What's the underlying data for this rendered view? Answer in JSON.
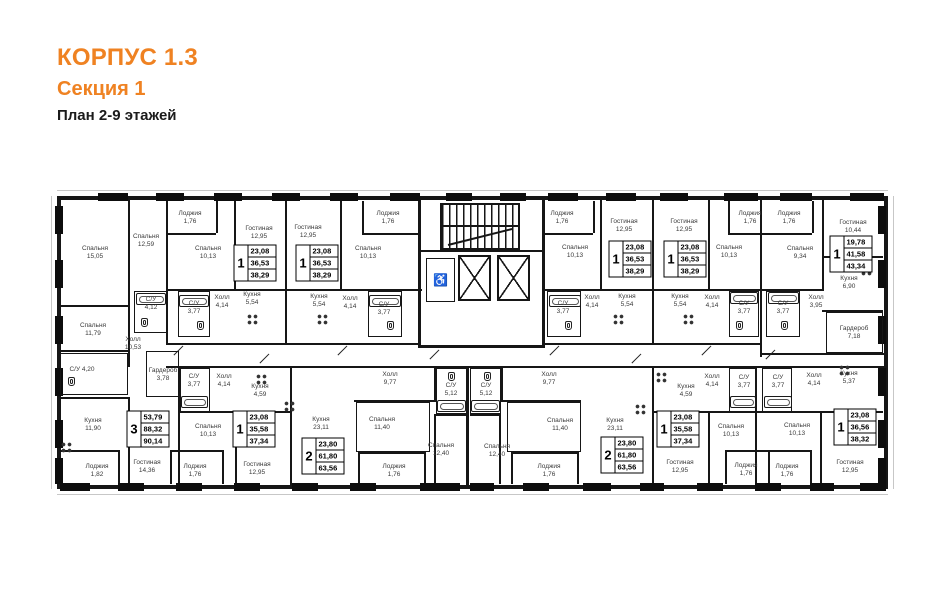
{
  "header": {
    "building": "КОРПУС 1.3",
    "section": "Секция 1",
    "plan_title": "План 2-9 этажей"
  },
  "colors": {
    "accent": "#ef8222",
    "wall": "#161616",
    "text": "#3a3a3a"
  },
  "core": {
    "wheelchair_glyph": "♿"
  },
  "plan": {
    "rooms": [
      {
        "n": "Спальня",
        "a": "15,05",
        "x": 95,
        "y": 253
      },
      {
        "n": "Спальня",
        "a": "12,59",
        "x": 146,
        "y": 241
      },
      {
        "n": "Лоджия",
        "a": "1,76",
        "x": 190,
        "y": 218
      },
      {
        "n": "Спальня",
        "a": "10,13",
        "x": 208,
        "y": 253
      },
      {
        "n": "Гостиная",
        "a": "12,95",
        "x": 259,
        "y": 233
      },
      {
        "n": "С/У",
        "a": "4,12",
        "x": 151,
        "y": 304
      },
      {
        "n": "С/У",
        "a": "3,77",
        "x": 194,
        "y": 308
      },
      {
        "n": "Холл",
        "a": "4,14",
        "x": 222,
        "y": 302
      },
      {
        "n": "Кухня",
        "a": "5,54",
        "x": 252,
        "y": 299
      },
      {
        "n": "Гостиная",
        "a": "12,95",
        "x": 308,
        "y": 232
      },
      {
        "n": "Спальня",
        "a": "10,13",
        "x": 368,
        "y": 253
      },
      {
        "n": "Лоджия",
        "a": "1,76",
        "x": 388,
        "y": 218
      },
      {
        "n": "Кухня",
        "a": "5,54",
        "x": 319,
        "y": 301
      },
      {
        "n": "Холл",
        "a": "4,14",
        "x": 350,
        "y": 303
      },
      {
        "n": "С/У",
        "a": "3,77",
        "x": 384,
        "y": 309
      },
      {
        "n": "Лоджия",
        "a": "1,76",
        "x": 562,
        "y": 218
      },
      {
        "n": "Спальня",
        "a": "10,13",
        "x": 575,
        "y": 252
      },
      {
        "n": "Гостиная",
        "a": "12,95",
        "x": 624,
        "y": 226
      },
      {
        "n": "С/У",
        "a": "3,77",
        "x": 563,
        "y": 308
      },
      {
        "n": "Холл",
        "a": "4,14",
        "x": 592,
        "y": 302
      },
      {
        "n": "Кухня",
        "a": "5,54",
        "x": 627,
        "y": 301
      },
      {
        "n": "Гостиная",
        "a": "12,95",
        "x": 684,
        "y": 226
      },
      {
        "n": "Спальня",
        "a": "10,13",
        "x": 729,
        "y": 252
      },
      {
        "n": "Кухня",
        "a": "5,54",
        "x": 680,
        "y": 301
      },
      {
        "n": "Холл",
        "a": "4,14",
        "x": 712,
        "y": 302
      },
      {
        "n": "С/У",
        "a": "3,77",
        "x": 744,
        "y": 308
      },
      {
        "n": "Лоджия",
        "a": "1,76",
        "x": 750,
        "y": 218
      },
      {
        "n": "Лоджия",
        "a": "1,76",
        "x": 789,
        "y": 218
      },
      {
        "n": "Спальня",
        "a": "9,34",
        "x": 800,
        "y": 253
      },
      {
        "n": "Гостиная",
        "a": "10,44",
        "x": 853,
        "y": 227
      },
      {
        "n": "Кухня",
        "a": "6,90",
        "x": 849,
        "y": 283
      },
      {
        "n": "С/У",
        "a": "3,77",
        "x": 783,
        "y": 308
      },
      {
        "n": "Холл",
        "a": "3,95",
        "x": 816,
        "y": 302
      },
      {
        "n": "Гардероб",
        "a": "7,18",
        "x": 854,
        "y": 333
      },
      {
        "n": "Спальня",
        "a": "11,79",
        "x": 93,
        "y": 330
      },
      {
        "n": "Холл",
        "a": "10,53",
        "x": 133,
        "y": 344
      },
      {
        "n": "С/У",
        "a": "4,20",
        "x": 82,
        "y": 370,
        "i": 1
      },
      {
        "n": "Гардероб",
        "a": "3,78",
        "x": 163,
        "y": 375
      },
      {
        "n": "Кухня",
        "a": "11,90",
        "x": 93,
        "y": 425
      },
      {
        "n": "Гостиная",
        "a": "14,36",
        "x": 147,
        "y": 467
      },
      {
        "n": "Лоджия",
        "a": "1,82",
        "x": 97,
        "y": 471
      },
      {
        "n": "С/У",
        "a": "3,77",
        "x": 194,
        "y": 381
      },
      {
        "n": "Холл",
        "a": "4,14",
        "x": 224,
        "y": 381
      },
      {
        "n": "Кухня",
        "a": "4,59",
        "x": 260,
        "y": 391
      },
      {
        "n": "Спальня",
        "a": "10,13",
        "x": 208,
        "y": 431
      },
      {
        "n": "Гостиная",
        "a": "12,95",
        "x": 257,
        "y": 469
      },
      {
        "n": "Лоджия",
        "a": "1,76",
        "x": 195,
        "y": 471
      },
      {
        "n": "Холл",
        "a": "9,77",
        "x": 390,
        "y": 379
      },
      {
        "n": "С/У",
        "a": "5,12",
        "x": 451,
        "y": 390
      },
      {
        "n": "Кухня",
        "a": "23,11",
        "x": 321,
        "y": 424
      },
      {
        "n": "Спальня",
        "a": "11,40",
        "x": 382,
        "y": 424
      },
      {
        "n": "Спальня",
        "a": "12,40",
        "x": 441,
        "y": 450
      },
      {
        "n": "Лоджия",
        "a": "1,76",
        "x": 394,
        "y": 471
      },
      {
        "n": "С/У",
        "a": "5,12",
        "x": 486,
        "y": 390
      },
      {
        "n": "Холл",
        "a": "9,77",
        "x": 549,
        "y": 379
      },
      {
        "n": "Спальня",
        "a": "12,40",
        "x": 497,
        "y": 451
      },
      {
        "n": "Спальня",
        "a": "11,40",
        "x": 560,
        "y": 425
      },
      {
        "n": "Кухня",
        "a": "23,11",
        "x": 615,
        "y": 425
      },
      {
        "n": "Лоджия",
        "a": "1,76",
        "x": 549,
        "y": 471
      },
      {
        "n": "Кухня",
        "a": "4,59",
        "x": 686,
        "y": 391
      },
      {
        "n": "Холл",
        "a": "4,14",
        "x": 712,
        "y": 381
      },
      {
        "n": "С/У",
        "a": "3,77",
        "x": 744,
        "y": 382
      },
      {
        "n": "Гостиная",
        "a": "12,95",
        "x": 680,
        "y": 467
      },
      {
        "n": "Спальня",
        "a": "10,13",
        "x": 731,
        "y": 431
      },
      {
        "n": "Лоджия",
        "a": "1,76",
        "x": 746,
        "y": 470
      },
      {
        "n": "С/У",
        "a": "3,77",
        "x": 778,
        "y": 382
      },
      {
        "n": "Холл",
        "a": "4,14",
        "x": 814,
        "y": 380
      },
      {
        "n": "Кухня",
        "a": "5,37",
        "x": 849,
        "y": 378
      },
      {
        "n": "Спальня",
        "a": "10,13",
        "x": 797,
        "y": 430
      },
      {
        "n": "Гостиная",
        "a": "12,95",
        "x": 850,
        "y": 467
      },
      {
        "n": "Лоджия",
        "a": "1,76",
        "x": 787,
        "y": 471
      }
    ],
    "apartments": [
      {
        "num": "3",
        "living": "53,79",
        "area": "88,32",
        "total": "90,14",
        "x": 148,
        "y": 429
      },
      {
        "num": "1",
        "living": "23,08",
        "area": "36,53",
        "total": "38,29",
        "x": 255,
        "y": 263
      },
      {
        "num": "1",
        "living": "23,08",
        "area": "36,53",
        "total": "38,29",
        "x": 317,
        "y": 263
      },
      {
        "num": "1",
        "living": "23,08",
        "area": "36,53",
        "total": "38,29",
        "x": 630,
        "y": 259
      },
      {
        "num": "1",
        "living": "23,08",
        "area": "36,53",
        "total": "38,29",
        "x": 685,
        "y": 259
      },
      {
        "num": "1",
        "living": "19,78",
        "area": "41,58",
        "total": "43,34",
        "x": 851,
        "y": 254
      },
      {
        "num": "1",
        "living": "23,08",
        "area": "35,58",
        "total": "37,34",
        "x": 254,
        "y": 429
      },
      {
        "num": "2",
        "living": "23,80",
        "area": "61,80",
        "total": "63,56",
        "x": 323,
        "y": 456
      },
      {
        "num": "2",
        "living": "23,80",
        "area": "61,80",
        "total": "63,56",
        "x": 622,
        "y": 455
      },
      {
        "num": "1",
        "living": "23,08",
        "area": "35,58",
        "total": "37,34",
        "x": 678,
        "y": 429
      },
      {
        "num": "1",
        "living": "23,08",
        "area": "36,56",
        "total": "38,32",
        "x": 855,
        "y": 427
      }
    ]
  }
}
